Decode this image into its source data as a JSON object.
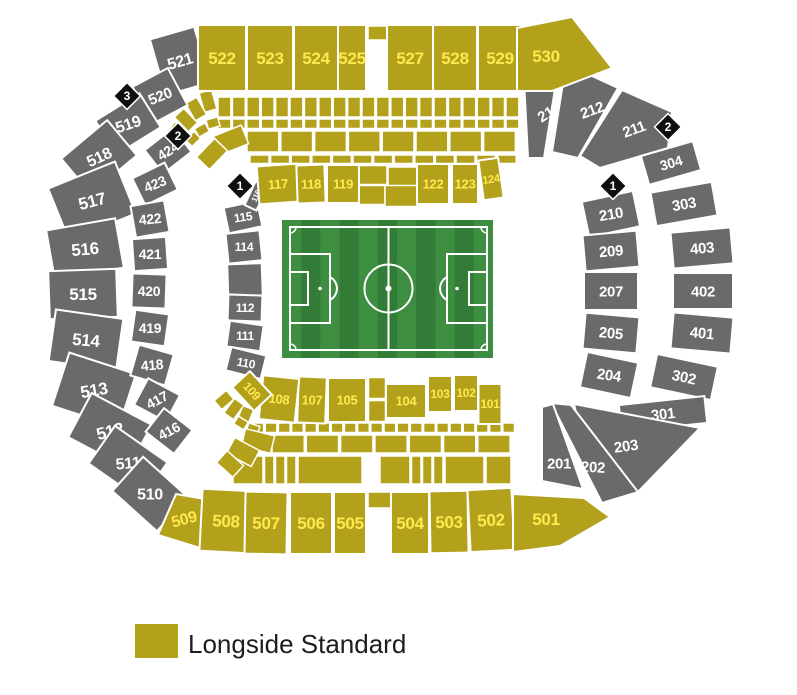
{
  "colors": {
    "longside": "#B3A11B",
    "longside_text": "#FFE94E",
    "standard": "#6A6A6A",
    "standard_text": "#FFFFFF",
    "marker_bg": "#0F0F0F",
    "pitch_green_light": "#3E8E42",
    "pitch_green_dark": "#327C37",
    "pitch_line": "#FFFFFF"
  },
  "stadium": {
    "sections": [
      {
        "id": "521",
        "label": "521",
        "category": "standard"
      },
      {
        "id": "520",
        "label": "520",
        "category": "standard"
      },
      {
        "id": "519",
        "label": "519",
        "category": "standard"
      },
      {
        "id": "518",
        "label": "518",
        "category": "standard"
      },
      {
        "id": "517",
        "label": "517",
        "category": "standard"
      },
      {
        "id": "516",
        "label": "516",
        "category": "standard"
      },
      {
        "id": "515",
        "label": "515",
        "category": "standard"
      },
      {
        "id": "514",
        "label": "514",
        "category": "standard"
      },
      {
        "id": "513",
        "label": "513",
        "category": "standard"
      },
      {
        "id": "512",
        "label": "512",
        "category": "standard"
      },
      {
        "id": "511",
        "label": "511",
        "category": "standard"
      },
      {
        "id": "510",
        "label": "510",
        "category": "standard"
      },
      {
        "id": "424",
        "label": "424",
        "category": "standard"
      },
      {
        "id": "423",
        "label": "423",
        "category": "standard"
      },
      {
        "id": "422",
        "label": "422",
        "category": "standard"
      },
      {
        "id": "421",
        "label": "421",
        "category": "standard"
      },
      {
        "id": "420",
        "label": "420",
        "category": "standard"
      },
      {
        "id": "419",
        "label": "419",
        "category": "standard"
      },
      {
        "id": "418",
        "label": "418",
        "category": "standard"
      },
      {
        "id": "417",
        "label": "417",
        "category": "standard"
      },
      {
        "id": "416",
        "label": "416",
        "category": "standard"
      },
      {
        "id": "115",
        "label": "115",
        "category": "standard"
      },
      {
        "id": "114",
        "label": "114",
        "category": "standard"
      },
      {
        "id": "112",
        "label": "112",
        "category": "standard"
      },
      {
        "id": "111",
        "label": "111",
        "category": "standard"
      },
      {
        "id": "110",
        "label": "110",
        "category": "standard"
      },
      {
        "id": "116",
        "label": "116",
        "category": "standard"
      },
      {
        "id": "213",
        "label": "213",
        "category": "standard"
      },
      {
        "id": "212",
        "label": "212",
        "category": "standard"
      },
      {
        "id": "211",
        "label": "211",
        "category": "standard"
      },
      {
        "id": "304",
        "label": "304",
        "category": "standard"
      },
      {
        "id": "303",
        "label": "303",
        "category": "standard"
      },
      {
        "id": "403",
        "label": "403",
        "category": "standard"
      },
      {
        "id": "402",
        "label": "402",
        "category": "standard"
      },
      {
        "id": "401",
        "label": "401",
        "category": "standard"
      },
      {
        "id": "302",
        "label": "302",
        "category": "standard"
      },
      {
        "id": "301",
        "label": "301",
        "category": "standard"
      },
      {
        "id": "210",
        "label": "210",
        "category": "standard"
      },
      {
        "id": "209",
        "label": "209",
        "category": "standard"
      },
      {
        "id": "207",
        "label": "207",
        "category": "standard"
      },
      {
        "id": "205",
        "label": "205",
        "category": "standard"
      },
      {
        "id": "204",
        "label": "204",
        "category": "standard"
      },
      {
        "id": "203",
        "label": "203",
        "category": "standard"
      },
      {
        "id": "202",
        "label": "202",
        "category": "standard"
      },
      {
        "id": "201",
        "label": "201",
        "category": "standard"
      },
      {
        "id": "522",
        "label": "522",
        "category": "longside"
      },
      {
        "id": "523",
        "label": "523",
        "category": "longside"
      },
      {
        "id": "524",
        "label": "524",
        "category": "longside"
      },
      {
        "id": "525",
        "label": "525",
        "category": "longside"
      },
      {
        "id": "527",
        "label": "527",
        "category": "longside"
      },
      {
        "id": "528",
        "label": "528",
        "category": "longside"
      },
      {
        "id": "529",
        "label": "529",
        "category": "longside"
      },
      {
        "id": "530",
        "label": "530",
        "category": "longside"
      },
      {
        "id": "509",
        "label": "509",
        "category": "longside"
      },
      {
        "id": "508",
        "label": "508",
        "category": "longside"
      },
      {
        "id": "507",
        "label": "507",
        "category": "longside"
      },
      {
        "id": "506",
        "label": "506",
        "category": "longside"
      },
      {
        "id": "505",
        "label": "505",
        "category": "longside"
      },
      {
        "id": "504",
        "label": "504",
        "category": "longside"
      },
      {
        "id": "503",
        "label": "503",
        "category": "longside"
      },
      {
        "id": "502",
        "label": "502",
        "category": "longside"
      },
      {
        "id": "501",
        "label": "501",
        "category": "longside"
      },
      {
        "id": "117",
        "label": "117",
        "category": "longside"
      },
      {
        "id": "118",
        "label": "118",
        "category": "longside"
      },
      {
        "id": "119",
        "label": "119",
        "category": "longside"
      },
      {
        "id": "122",
        "label": "122",
        "category": "longside"
      },
      {
        "id": "123",
        "label": "123",
        "category": "longside"
      },
      {
        "id": "124",
        "label": "124",
        "category": "longside"
      },
      {
        "id": "101",
        "label": "101",
        "category": "longside"
      },
      {
        "id": "102",
        "label": "102",
        "category": "longside"
      },
      {
        "id": "103",
        "label": "103",
        "category": "longside"
      },
      {
        "id": "104",
        "label": "104",
        "category": "longside"
      },
      {
        "id": "105",
        "label": "105",
        "category": "longside"
      },
      {
        "id": "107",
        "label": "107",
        "category": "longside"
      },
      {
        "id": "108",
        "label": "108",
        "category": "longside"
      },
      {
        "id": "109",
        "label": "109",
        "category": "longside"
      }
    ],
    "markers": [
      {
        "label": "3",
        "side": "left"
      },
      {
        "label": "2",
        "side": "left"
      },
      {
        "label": "1",
        "side": "left"
      },
      {
        "label": "2",
        "side": "right"
      },
      {
        "label": "1",
        "side": "right"
      }
    ]
  },
  "legend": {
    "items": [
      {
        "label": "Longside Standard",
        "color": "#B3A11B"
      }
    ]
  }
}
